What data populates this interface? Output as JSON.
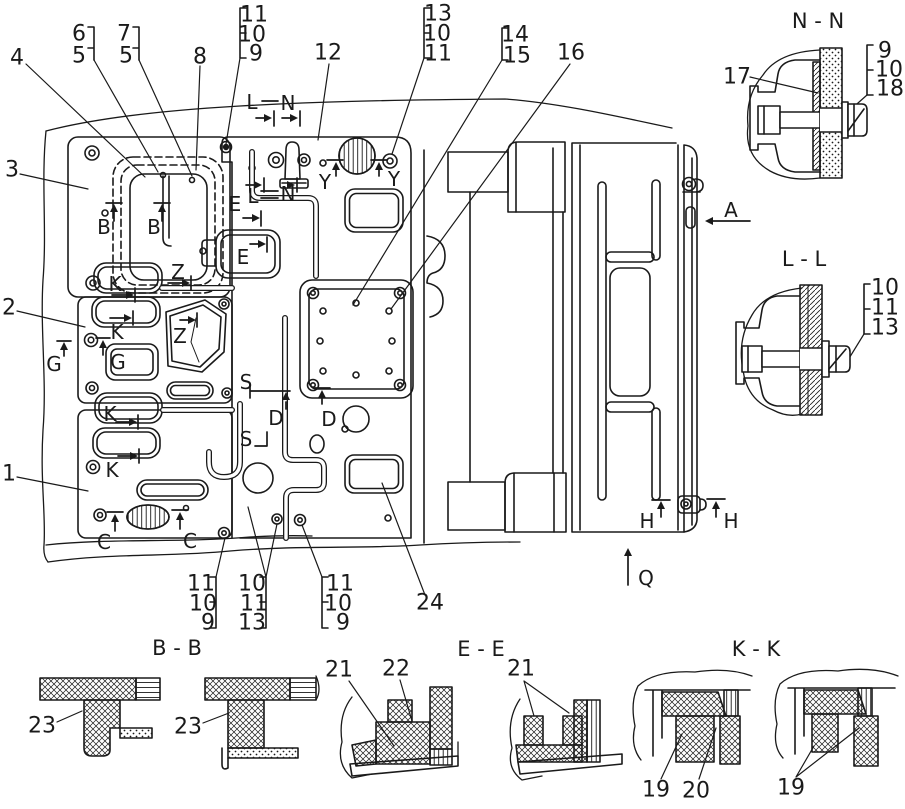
{
  "drawing": {
    "background": "#ffffff",
    "ink": "#1a1a1a"
  },
  "section_titles": {
    "nn": "N - N",
    "ll": "L - L",
    "bb": "B - B",
    "ee": "E - E",
    "kk": "K - K"
  },
  "labels": [
    {
      "name": "callout-4",
      "text": "4",
      "x": 17,
      "y": 58
    },
    {
      "name": "callout-6",
      "text": "6",
      "x": 79,
      "y": 34
    },
    {
      "name": "callout-5a",
      "text": "5",
      "x": 79,
      "y": 56
    },
    {
      "name": "callout-7",
      "text": "7",
      "x": 124,
      "y": 34
    },
    {
      "name": "callout-5b",
      "text": "5",
      "x": 126,
      "y": 56
    },
    {
      "name": "callout-8",
      "text": "8",
      "x": 200,
      "y": 57
    },
    {
      "name": "callout-11a",
      "text": "11",
      "x": 254,
      "y": 15
    },
    {
      "name": "callout-10a",
      "text": "10",
      "x": 252,
      "y": 35
    },
    {
      "name": "callout-9a",
      "text": "9",
      "x": 256,
      "y": 54
    },
    {
      "name": "callout-3",
      "text": "3",
      "x": 12,
      "y": 170
    },
    {
      "name": "callout-12",
      "text": "12",
      "x": 328,
      "y": 53
    },
    {
      "name": "callout-13a",
      "text": "13",
      "x": 438,
      "y": 14
    },
    {
      "name": "callout-10b",
      "text": "10",
      "x": 437,
      "y": 34
    },
    {
      "name": "callout-11b",
      "text": "11",
      "x": 438,
      "y": 54
    },
    {
      "name": "callout-14",
      "text": "14",
      "x": 515,
      "y": 35
    },
    {
      "name": "callout-15",
      "text": "15",
      "x": 517,
      "y": 56
    },
    {
      "name": "callout-16",
      "text": "16",
      "x": 571,
      "y": 53
    },
    {
      "name": "callout-2",
      "text": "2",
      "x": 9,
      "y": 308
    },
    {
      "name": "callout-1",
      "text": "1",
      "x": 9,
      "y": 474
    },
    {
      "name": "callout-11c",
      "text": "11",
      "x": 201,
      "y": 584
    },
    {
      "name": "callout-10c",
      "text": "10",
      "x": 203,
      "y": 604
    },
    {
      "name": "callout-9c",
      "text": "9",
      "x": 208,
      "y": 623
    },
    {
      "name": "callout-10d",
      "text": "10",
      "x": 252,
      "y": 584
    },
    {
      "name": "callout-11d",
      "text": "11",
      "x": 254,
      "y": 604
    },
    {
      "name": "callout-13d",
      "text": "13",
      "x": 252,
      "y": 623
    },
    {
      "name": "callout-11e",
      "text": "11",
      "x": 340,
      "y": 584
    },
    {
      "name": "callout-10e",
      "text": "10",
      "x": 338,
      "y": 604
    },
    {
      "name": "callout-9e",
      "text": "9",
      "x": 343,
      "y": 623
    },
    {
      "name": "callout-24",
      "text": "24",
      "x": 430,
      "y": 603
    },
    {
      "name": "callout-17",
      "text": "17",
      "x": 737,
      "y": 77
    },
    {
      "name": "callout-9f",
      "text": "9",
      "x": 885,
      "y": 51
    },
    {
      "name": "callout-10f",
      "text": "10",
      "x": 889,
      "y": 70
    },
    {
      "name": "callout-18",
      "text": "18",
      "x": 890,
      "y": 89
    },
    {
      "name": "callout-10g",
      "text": "10",
      "x": 885,
      "y": 288
    },
    {
      "name": "callout-11g",
      "text": "11",
      "x": 885,
      "y": 308
    },
    {
      "name": "callout-13g",
      "text": "13",
      "x": 885,
      "y": 328
    },
    {
      "name": "callout-23a",
      "text": "23",
      "x": 42,
      "y": 726
    },
    {
      "name": "callout-23b",
      "text": "23",
      "x": 188,
      "y": 727
    },
    {
      "name": "callout-21a",
      "text": "21",
      "x": 339,
      "y": 670
    },
    {
      "name": "callout-22",
      "text": "22",
      "x": 396,
      "y": 669
    },
    {
      "name": "callout-21b",
      "text": "21",
      "x": 521,
      "y": 669
    },
    {
      "name": "callout-19a",
      "text": "19",
      "x": 656,
      "y": 790
    },
    {
      "name": "callout-20",
      "text": "20",
      "x": 696,
      "y": 791
    },
    {
      "name": "callout-19b",
      "text": "19",
      "x": 791,
      "y": 788
    },
    {
      "name": "marker-B1",
      "text": "B",
      "x": 104,
      "y": 227
    },
    {
      "name": "marker-B2",
      "text": "B",
      "x": 154,
      "y": 227
    },
    {
      "name": "marker-C1",
      "text": "C",
      "x": 104,
      "y": 542
    },
    {
      "name": "marker-C2",
      "text": "C",
      "x": 190,
      "y": 541
    },
    {
      "name": "marker-D1",
      "text": "D",
      "x": 276,
      "y": 418
    },
    {
      "name": "marker-D2",
      "text": "D",
      "x": 329,
      "y": 419
    },
    {
      "name": "marker-E1",
      "text": "E",
      "x": 235,
      "y": 204
    },
    {
      "name": "marker-E2",
      "text": "E",
      "x": 243,
      "y": 257
    },
    {
      "name": "marker-G1",
      "text": "G",
      "x": 54,
      "y": 364
    },
    {
      "name": "marker-G2",
      "text": "G",
      "x": 118,
      "y": 362
    },
    {
      "name": "marker-K1",
      "text": "K",
      "x": 115,
      "y": 284
    },
    {
      "name": "marker-K2",
      "text": "K",
      "x": 117,
      "y": 332
    },
    {
      "name": "marker-K3",
      "text": "K",
      "x": 110,
      "y": 414
    },
    {
      "name": "marker-K4",
      "text": "K",
      "x": 112,
      "y": 470
    },
    {
      "name": "marker-L1",
      "text": "L",
      "x": 252,
      "y": 102
    },
    {
      "name": "marker-N1",
      "text": "N",
      "x": 288,
      "y": 103
    },
    {
      "name": "marker-L2",
      "text": "L",
      "x": 253,
      "y": 196
    },
    {
      "name": "marker-N2",
      "text": "N",
      "x": 288,
      "y": 194
    },
    {
      "name": "marker-S1",
      "text": "S",
      "x": 246,
      "y": 382
    },
    {
      "name": "marker-S2",
      "text": "S",
      "x": 246,
      "y": 439
    },
    {
      "name": "marker-Y1",
      "text": "Y",
      "x": 325,
      "y": 182
    },
    {
      "name": "marker-Y2",
      "text": "Y",
      "x": 394,
      "y": 179
    },
    {
      "name": "marker-Z1",
      "text": "Z",
      "x": 178,
      "y": 272
    },
    {
      "name": "marker-Z2",
      "text": "Z",
      "x": 180,
      "y": 336
    },
    {
      "name": "marker-A",
      "text": "A",
      "x": 731,
      "y": 210
    },
    {
      "name": "marker-H1",
      "text": "H",
      "x": 647,
      "y": 521
    },
    {
      "name": "marker-H2",
      "text": "H",
      "x": 731,
      "y": 521
    },
    {
      "name": "marker-Q",
      "text": "Q",
      "x": 646,
      "y": 578
    },
    {
      "name": "section-title-nn",
      "text": "N - N",
      "x": 818,
      "y": 21
    },
    {
      "name": "section-title-ll",
      "text": "L - L",
      "x": 804,
      "y": 259
    },
    {
      "name": "section-title-bb",
      "text": "B - B",
      "x": 177,
      "y": 648
    },
    {
      "name": "section-title-ee",
      "text": "E - E",
      "x": 481,
      "y": 649
    },
    {
      "name": "section-title-kk",
      "text": "K - K",
      "x": 756,
      "y": 649
    }
  ]
}
